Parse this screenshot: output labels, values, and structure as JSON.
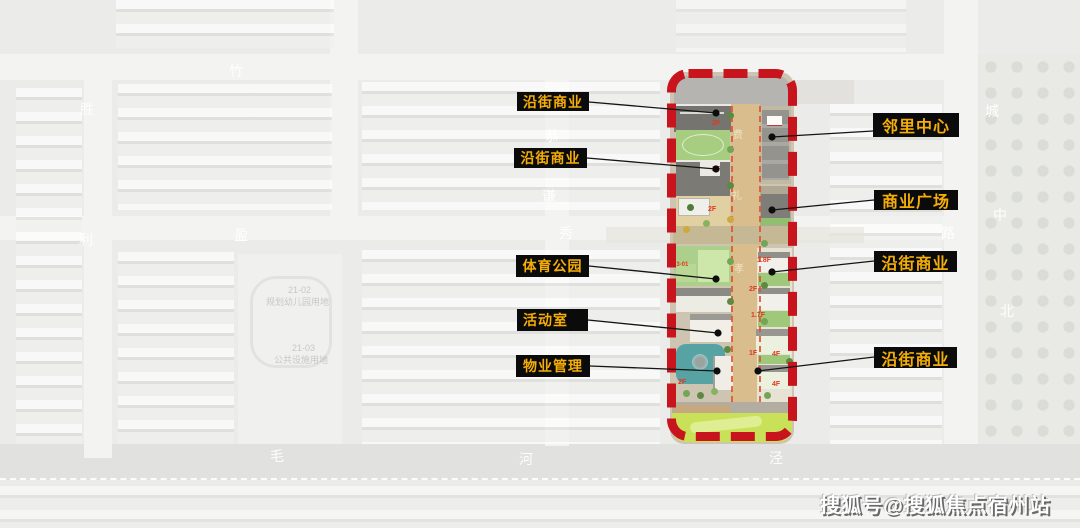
{
  "callouts": {
    "left": [
      "沿街商业",
      "沿街商业",
      "体育公园",
      "活动室",
      "物业管理"
    ],
    "right": [
      "邻里中心",
      "商业广场",
      "沿街商业",
      "沿街商业"
    ]
  },
  "plan": {
    "floor_labels": [
      "2F",
      "2F",
      "2F",
      "23-01",
      "2F",
      "1.8F",
      "2F",
      "1.7F",
      "1F",
      "4F",
      "4F"
    ],
    "street_chars": [
      "费",
      "礼",
      "孝"
    ]
  },
  "background": {
    "road_names": [
      "竹",
      "胜",
      "利",
      "盈",
      "恭",
      "谦",
      "秀",
      "路",
      "城",
      "中",
      "北",
      "毛",
      "河",
      "泾"
    ],
    "parcel_notes": [
      "21-02",
      "规划幼儿园用地",
      "21-03",
      "公共设施用地"
    ]
  },
  "watermark": "搜狐号@搜狐焦点宿州站",
  "colors": {
    "callout_bg": "#0b0b0b",
    "callout_text": "#f5ad08",
    "highlight_border": "#c8151d",
    "pond": "#57a2a2",
    "lawn": "#c9e158"
  }
}
